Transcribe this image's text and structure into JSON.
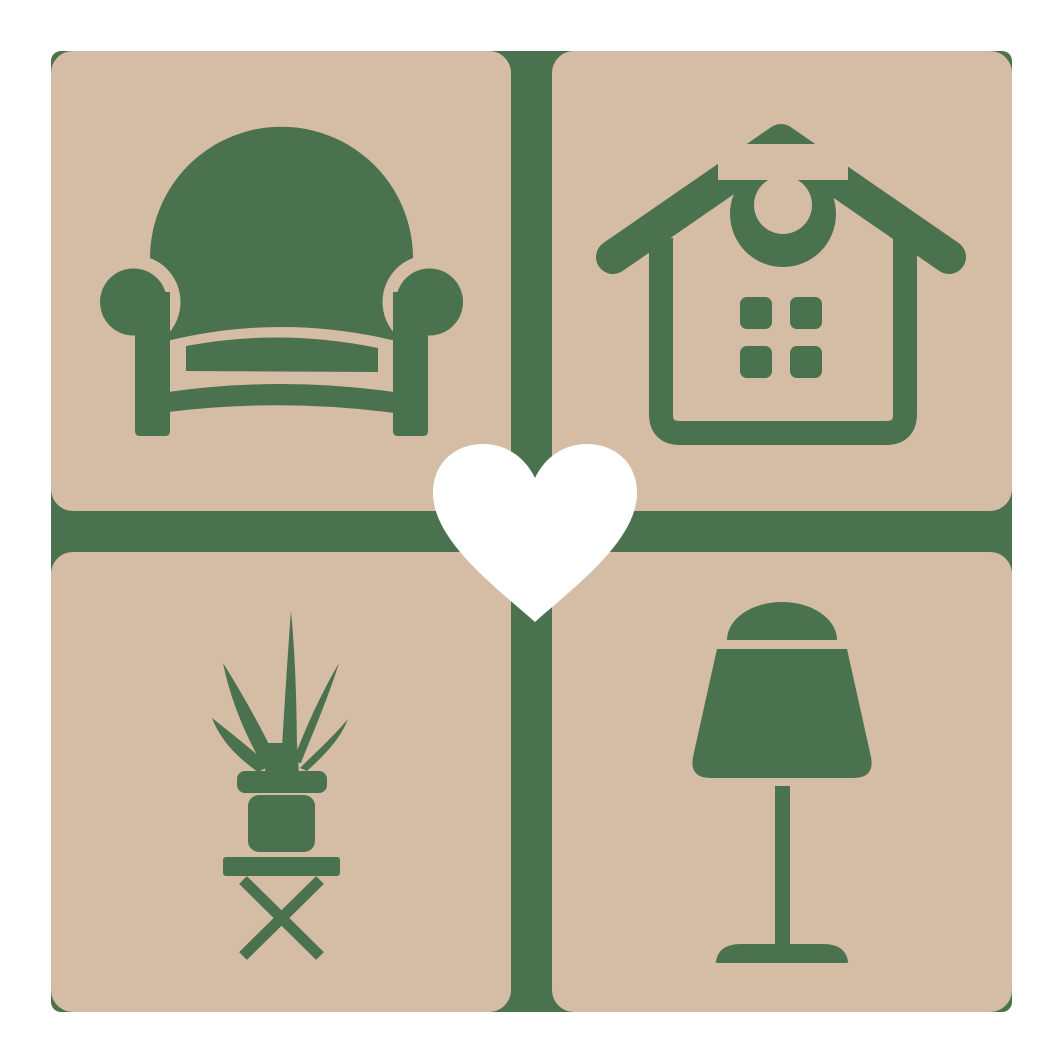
{
  "meta": {
    "type": "logo",
    "theme": "home-furniture-decor"
  },
  "colors": {
    "background": "#ffffff",
    "tile": "#d5bca4",
    "accent": "#4a724e",
    "heart": "#ffffff"
  },
  "layout": {
    "canvas_size": 1063,
    "backplate": {
      "x": 51,
      "y": 51,
      "size": 961,
      "radius": 10
    },
    "tile_size": 460,
    "tile_radius": 22,
    "gap": 41
  },
  "tiles": [
    {
      "id": "armchair",
      "icon": "armchair-icon",
      "position": "top-left"
    },
    {
      "id": "house",
      "icon": "house-icon",
      "position": "top-right"
    },
    {
      "id": "plant",
      "icon": "potted-plant-icon",
      "position": "bottom-left"
    },
    {
      "id": "lamp",
      "icon": "table-lamp-icon",
      "position": "bottom-right"
    }
  ],
  "center": {
    "id": "heart",
    "icon": "heart-icon"
  }
}
